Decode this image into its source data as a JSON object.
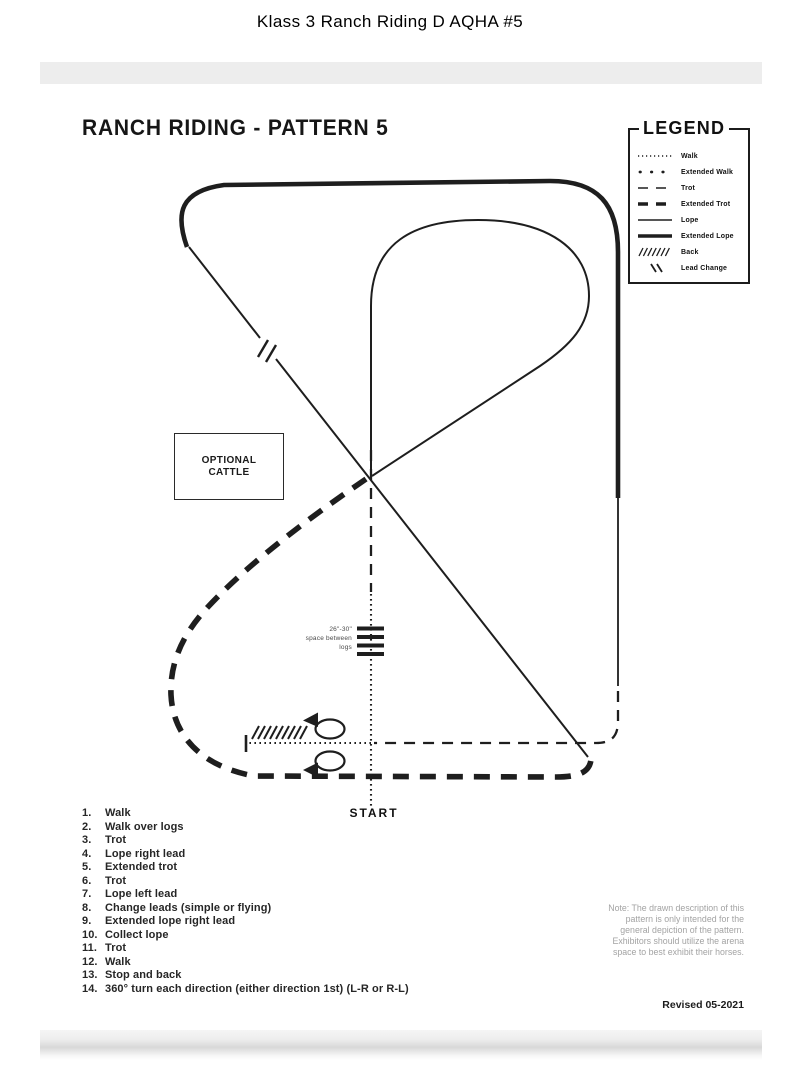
{
  "page_title": "Klass 3 Ranch Riding D AQHA #5",
  "colors": {
    "ink": "#1e1e1e",
    "note_gray": "#a3a3a3",
    "band_gray": "#ededed"
  },
  "document": {
    "heading": "RANCH RIDING - PATTERN 5",
    "legend": {
      "title": "LEGEND",
      "items": [
        {
          "style": "walk",
          "label": "Walk"
        },
        {
          "style": "extended-walk",
          "label": "Extended Walk"
        },
        {
          "style": "trot",
          "label": "Trot"
        },
        {
          "style": "extended-trot",
          "label": "Extended Trot"
        },
        {
          "style": "lope",
          "label": "Lope"
        },
        {
          "style": "extended-lope",
          "label": "Extended Lope"
        },
        {
          "style": "back",
          "label": "Back"
        },
        {
          "style": "lead-change",
          "label": "Lead Change"
        }
      ]
    },
    "diagram": {
      "optional_cattle_label": "OPTIONAL CATTLE",
      "logs_note_lines": [
        "26\"-30\"",
        "space between",
        "logs"
      ],
      "start_label": "START"
    },
    "maneuvers": [
      {
        "num": "1.",
        "text": "Walk"
      },
      {
        "num": "2.",
        "text": "Walk over logs"
      },
      {
        "num": "3.",
        "text": "Trot"
      },
      {
        "num": "4.",
        "text": "Lope right lead"
      },
      {
        "num": "5.",
        "text": "Extended trot"
      },
      {
        "num": "6.",
        "text": "Trot"
      },
      {
        "num": "7.",
        "text": "Lope left lead"
      },
      {
        "num": "8.",
        "text": "Change leads (simple or flying)"
      },
      {
        "num": "9.",
        "text": "Extended lope right lead"
      },
      {
        "num": "10.",
        "text": "Collect lope"
      },
      {
        "num": "11.",
        "text": "Trot"
      },
      {
        "num": "12.",
        "text": "Walk"
      },
      {
        "num": "13.",
        "text": "Stop and back"
      },
      {
        "num": "14.",
        "text": "360° turn each direction (either direction 1st) (L-R or R-L)"
      }
    ],
    "note_lines": [
      "Note: The drawn description of this",
      "pattern is only intended for the",
      "general depiction of the pattern.",
      "Exhibitors should utilize the arena",
      "space to best exhibit their horses."
    ],
    "revised": "Revised 05-2021"
  }
}
